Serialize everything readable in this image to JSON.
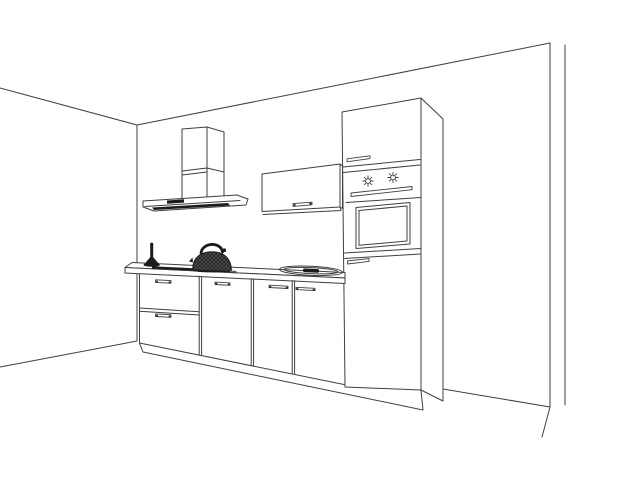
{
  "scene": {
    "description": "Black and white perspective line drawing of a kitchen run in a room corner: chimney range hood, horizontal wall cabinet, tall unit with built-in oven, base cabinets with two drawers and three doors on a plinth, countertop with cooktop strip, oval sink, a kettle and a pepper mill.",
    "objects": [
      "room-walls",
      "range-hood",
      "wall-cabinet",
      "tall-oven-cabinet",
      "built-in-oven",
      "countertop",
      "base-cabinets",
      "cooktop",
      "sink",
      "kettle",
      "pepper-mill"
    ]
  },
  "colors": {
    "background": "#ffffff",
    "line": "#3f3f3f",
    "dark": "#1b1b1b"
  }
}
